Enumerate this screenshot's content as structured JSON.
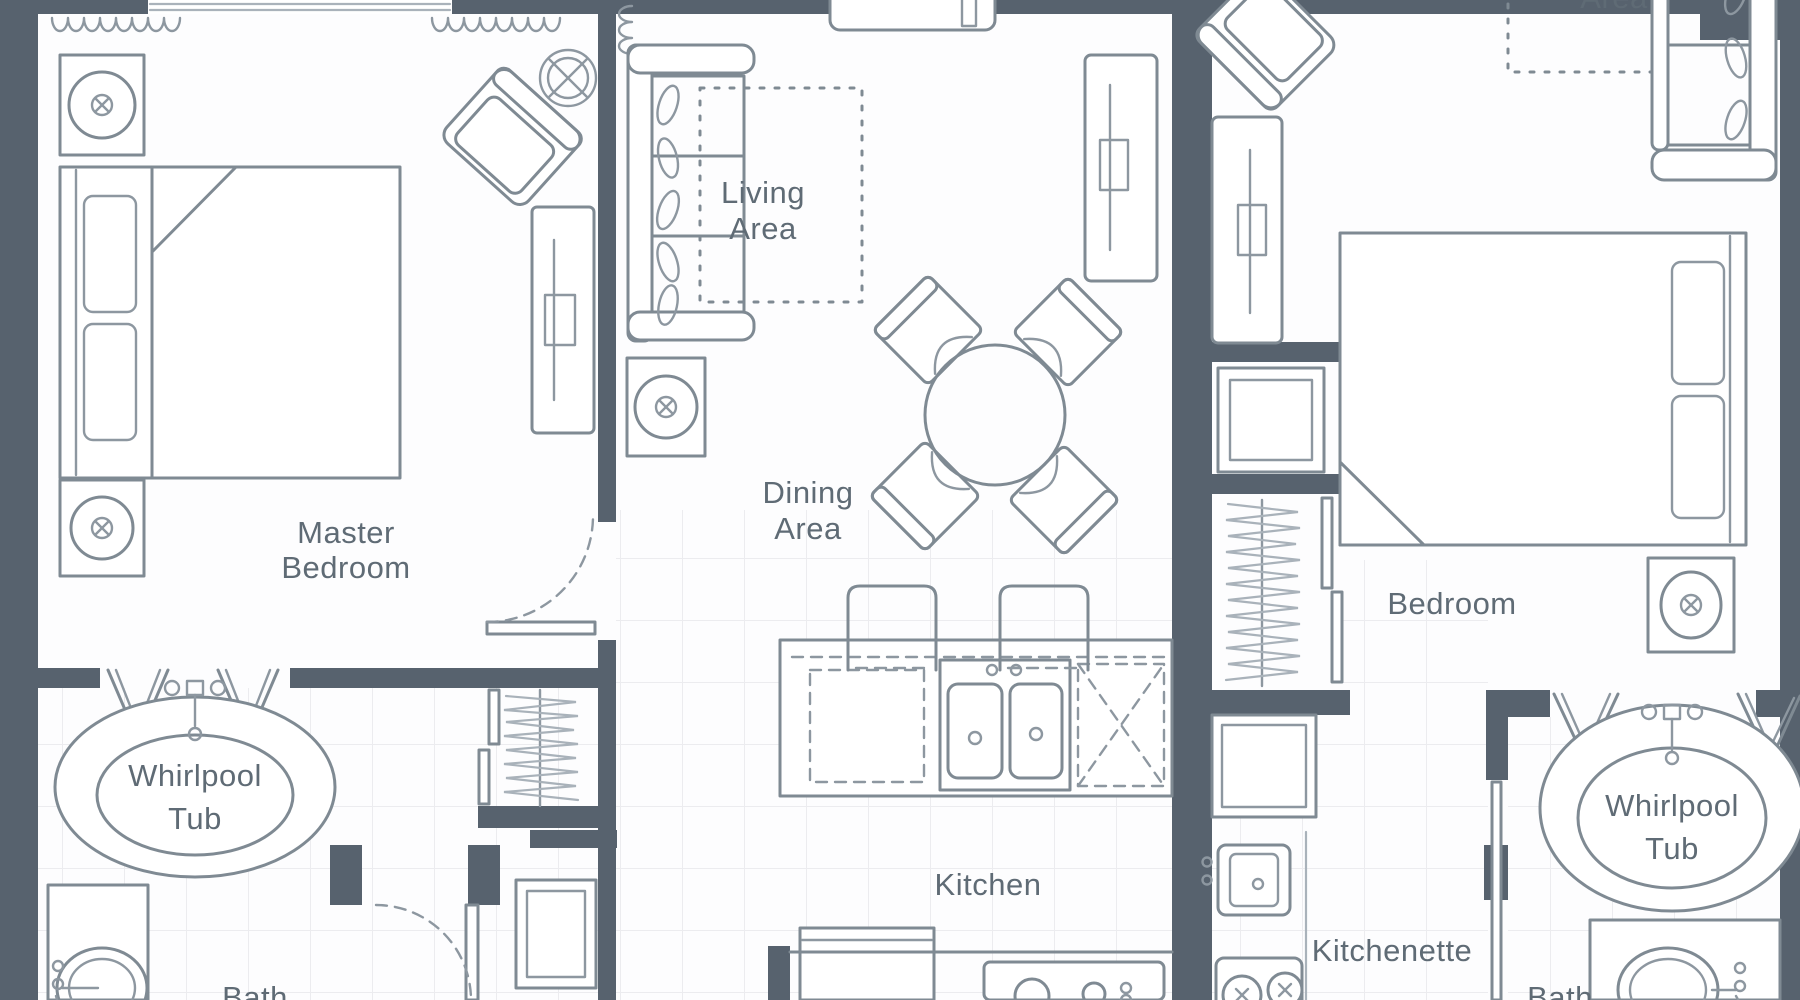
{
  "document": {
    "type": "floor-plan",
    "style": "architectural top-down suite plan, two-unit lockoff"
  },
  "colors": {
    "wall": "#57626e",
    "furniture_outline": "#7f8a93",
    "furniture_light": "#a9b2ba",
    "label_text": "#5f6b75",
    "tile_line": "#ececef",
    "background": "#fdfdfe"
  },
  "rooms": {
    "master_bedroom": {
      "line1": "Master",
      "line2": "Bedroom"
    },
    "living_area": {
      "line1": "Living",
      "line2": "Area"
    },
    "dining_area": {
      "line1": "Dining",
      "line2": "Area"
    },
    "kitchen": {
      "label": "Kitchen"
    },
    "kitchenette": {
      "label": "Kitchenette"
    },
    "bedroom": {
      "label": "Bedroom"
    },
    "master_whirlpool_tub": {
      "line1": "Whirlpool",
      "line2": "Tub"
    },
    "bedroom_whirlpool_tub": {
      "line1": "Whirlpool",
      "line2": "Tub"
    },
    "master_bath_partial": {
      "label": "Bath"
    },
    "bedroom_bath_partial": {
      "label": "Bath"
    },
    "top_right_partial": {
      "label": "Area"
    }
  }
}
